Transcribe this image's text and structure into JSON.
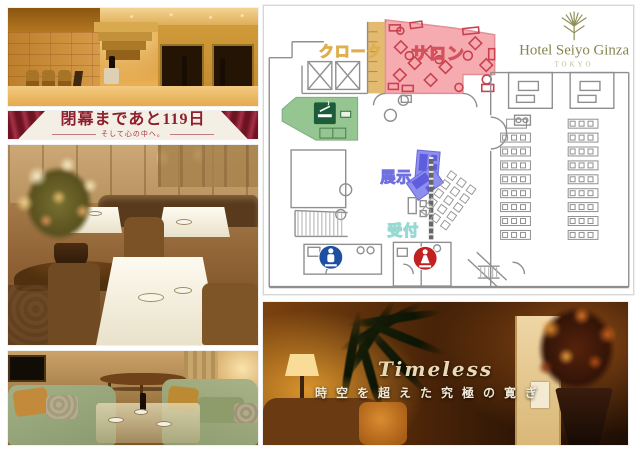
{
  "banner": {
    "countdown": "閉幕まであと119日",
    "subtitle": "そして心の中へ。"
  },
  "floorplan": {
    "logo": {
      "name": "Hotel Seiyo Ginza",
      "city": "TOKYO"
    },
    "labels": {
      "cloak": "クローク",
      "salon": "サロン",
      "exhibit": "展示",
      "reception": "受付"
    },
    "colors": {
      "cloak_fill": "#e2bb70",
      "cloak_label": "#dfae4f",
      "salon_fill": "#f6abb0",
      "salon_stroke": "#c9414f",
      "salon_label": "#d4515d",
      "smoking_fill": "#95c591",
      "smoking_badge": "#1d5c39",
      "exhibit_fill": "#8e8eec",
      "exhibit_inner": "#5d5dde",
      "exhibit_label": "#7070e0",
      "reception_label": "#97d9d3",
      "wall": "#8f8f8f",
      "mens_restroom": "#1e4fa1",
      "womens_restroom": "#c32020",
      "logo_green": "#8f9057"
    }
  },
  "timeless": {
    "title": "Timeless",
    "subtitle": "時空を超えた究極の寛ぎ"
  }
}
